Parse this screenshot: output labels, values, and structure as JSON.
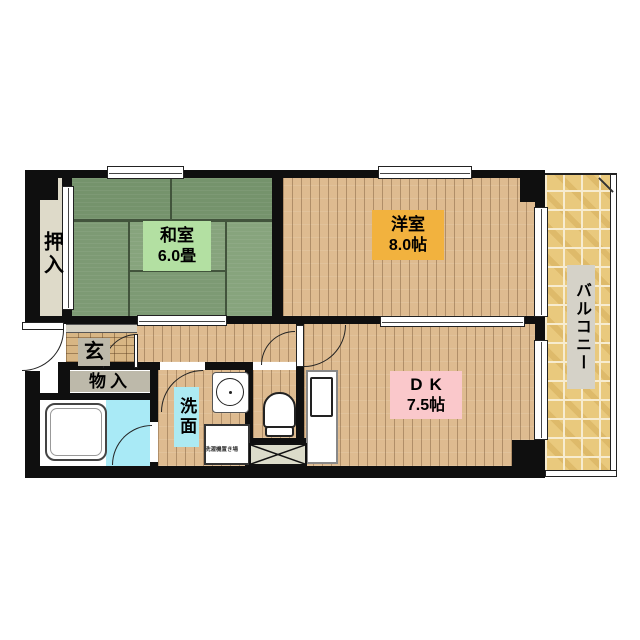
{
  "labels": {
    "washitsu_name": "和室",
    "washitsu_size": "6.0畳",
    "youshitsu_name": "洋室",
    "youshitsu_size": "8.0帖",
    "dk_name": "DK",
    "dk_size": "7.5帖",
    "oshiire": "押入",
    "monoire": "物入",
    "genkan": "玄",
    "senmen": "洗面",
    "balcony": "バルコニー",
    "laundry": "洗濯機置き場"
  },
  "colors": {
    "wall": "#0f0f0f",
    "tatamiA": "#75936c",
    "tatamiB": "#7d9a74",
    "tatamiC": "#87a47d",
    "tatamiLine": "#42543c",
    "wood": "#debb90",
    "woodLine": "rgba(120,88,55,0.45)",
    "tile": "#e9c97d",
    "tileLine": "#f7ecd0",
    "beige": "#dedac9",
    "grayBox": "#bdb9aa",
    "stepGray": "#d6d2c4",
    "bathFloor": "#a9eaf6",
    "labelGreen": "#b3e0a2",
    "labelOrange": "#f2b23e",
    "labelPink": "#fac8cb",
    "labelCyan": "#aceaf2",
    "labelGray": "#d5d2c8",
    "xboxBg": "#dcdcca"
  }
}
